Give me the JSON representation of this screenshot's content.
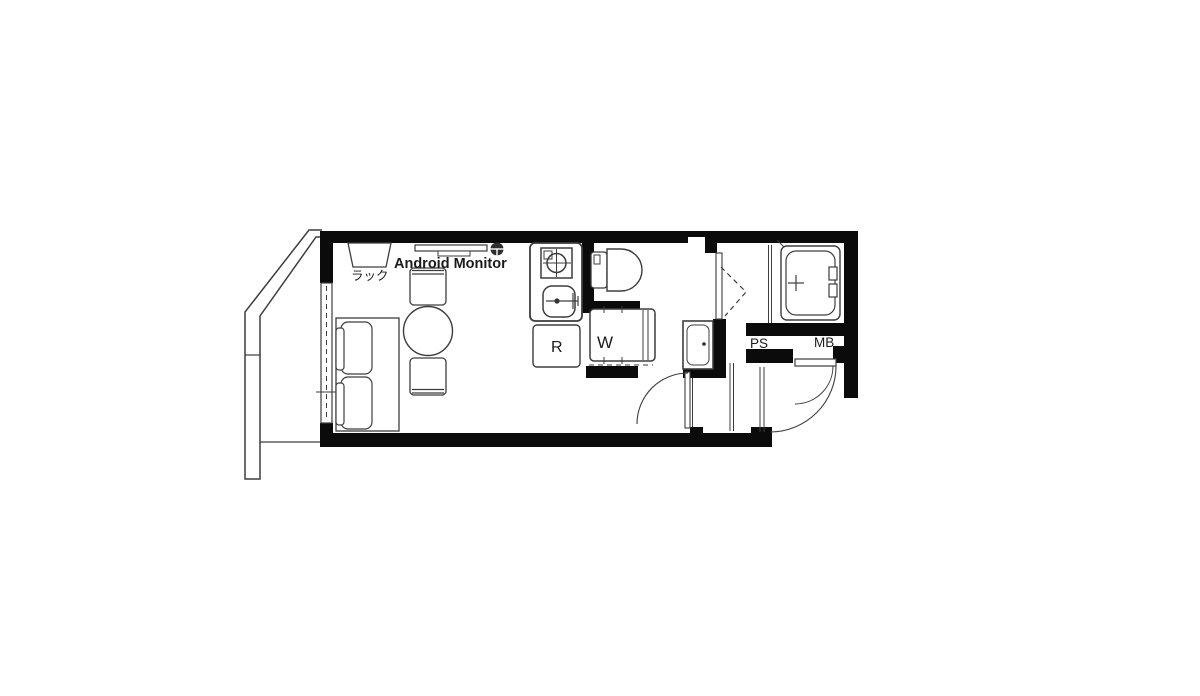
{
  "title": "apartment-floor-plan",
  "colors": {
    "background": "#ffffff",
    "wall": "#0b0b0b",
    "line": "#3d3d3d",
    "fixture": "#2e2e2e",
    "text": "#1b1b1b"
  },
  "floorplan": {
    "labels": {
      "rack": "ラック",
      "monitor": "Android Monitor",
      "refrigerator": "R",
      "washing_machine": "W",
      "pipe_space": "PS",
      "meter_box": "MB"
    }
  }
}
